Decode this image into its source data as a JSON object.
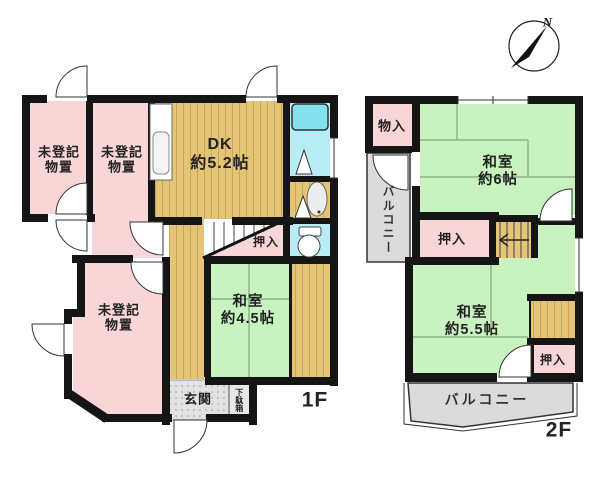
{
  "colors": {
    "wall": "#151515",
    "pink": "#F8D6D7",
    "green": "#C8F3C0",
    "wood": "#E4C577",
    "wood_stripe": "#CBA455",
    "bath": "#B9EDF5",
    "tub": "#86E2EF",
    "gray": "#DBDBDB",
    "genkan": "#E2E2E2",
    "tatami_line": "#7FA67C"
  },
  "compass": {
    "north": "N"
  },
  "floor1": {
    "label": "1F",
    "storage_a": "未登記\n物置",
    "storage_b": "未登記\n物置",
    "storage_c": "未登記\n物置",
    "dk": "DK\n約5.2帖",
    "oshiire": "押入",
    "washitsu_45": "和室\n約4.5帖",
    "genkan": "玄関",
    "getabako": "下駄箱"
  },
  "floor2": {
    "label": "2F",
    "monoiri": "物入",
    "washitsu_6": "和室\n約6帖",
    "balcony_side": "バルコニー",
    "oshiire_upper": "押入",
    "washitsu_55": "和室\n約5.5帖",
    "oshiire_lower": "押入",
    "balcony_bottom": "バルコニー"
  }
}
